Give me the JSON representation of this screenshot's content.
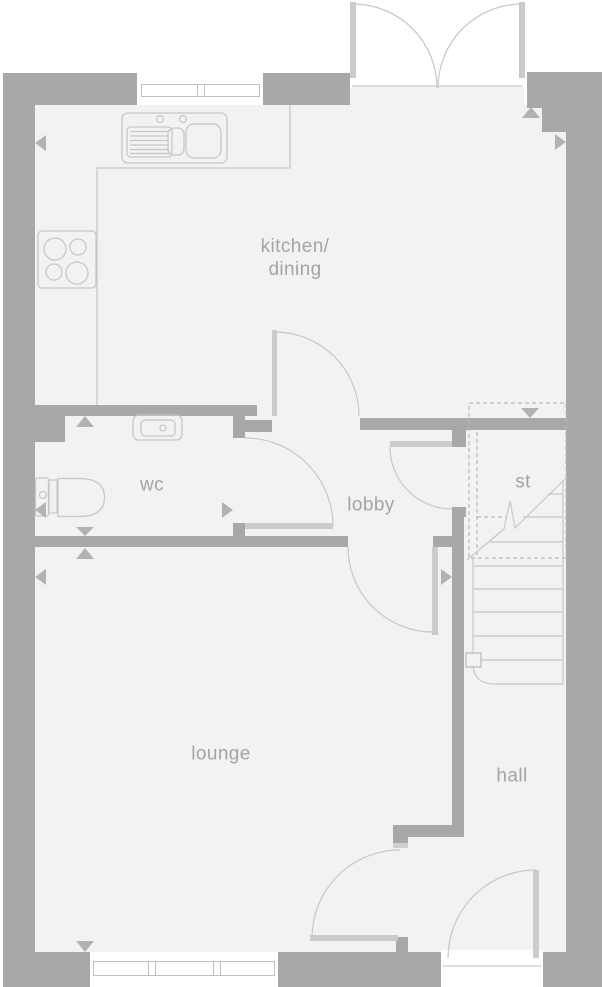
{
  "rooms": [
    {
      "name": "kitchen-dining",
      "label_lines": [
        "kitchen/",
        "dining"
      ]
    },
    {
      "name": "wc",
      "label": "wc"
    },
    {
      "name": "lobby",
      "label": "lobby"
    },
    {
      "name": "st",
      "label": "st"
    },
    {
      "name": "lounge",
      "label": "lounge"
    },
    {
      "name": "hall",
      "label": "hall"
    }
  ],
  "fixtures": [
    {
      "name": "sink-drainer",
      "room": "kitchen-dining"
    },
    {
      "name": "hob",
      "room": "kitchen-dining"
    },
    {
      "name": "worktop",
      "room": "kitchen-dining"
    },
    {
      "name": "toilet",
      "room": "wc"
    },
    {
      "name": "basin",
      "room": "wc"
    },
    {
      "name": "staircase",
      "room": "hall"
    }
  ],
  "doors": [
    "french-doors",
    "kitchen-lobby-door",
    "wc-door",
    "lobby-hall-door",
    "lounge-door",
    "lounge-hall-door",
    "front-door"
  ],
  "windows": [
    "kitchen-window",
    "lounge-window"
  ],
  "colors": {
    "wall": "#a8a8a8",
    "floor": "#f2f2f3",
    "outline": "#c4c8ca",
    "door_leaf": "#cbcbcb",
    "dashed": "#b6babc",
    "dimension_marker": "#b0b3b5",
    "label_text": "#a0a5a8",
    "background": "#ffffff"
  }
}
